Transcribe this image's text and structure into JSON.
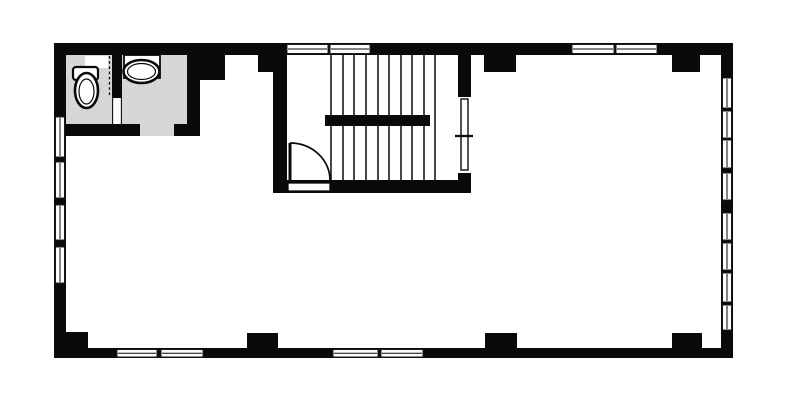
{
  "meta": {
    "drawing_type": "architectural-floor-plan",
    "visible_text": ""
  },
  "canvas": {
    "w": 787,
    "h": 401,
    "bg": "#ffffff"
  },
  "palette": {
    "wall": "#0a0a0a",
    "floor": "#ffffff",
    "bathroom_floor": "#d9d9d9",
    "bathroom_floor_dot": "#bdbdbd",
    "window_fill": "#fcfcfc",
    "window_frame": "#1a1a1a",
    "fixture_fill": "#ffffff",
    "line": "#0a0a0a"
  },
  "walls": {
    "outer": [
      {
        "name": "outer-wall-top",
        "x": 54,
        "y": 43,
        "w": 679,
        "h": 12
      },
      {
        "name": "outer-wall-bottom",
        "x": 54,
        "y": 348,
        "w": 679,
        "h": 10
      },
      {
        "name": "outer-wall-left",
        "x": 54,
        "y": 43,
        "w": 12,
        "h": 315
      },
      {
        "name": "outer-wall-right",
        "x": 721,
        "y": 43,
        "w": 12,
        "h": 315
      }
    ],
    "inner": [
      {
        "name": "bathroom-wall-right",
        "x": 187,
        "y": 55,
        "w": 13,
        "h": 81
      },
      {
        "name": "bathroom-wall-bottom-left",
        "x": 66,
        "y": 124,
        "w": 74,
        "h": 12
      },
      {
        "name": "bathroom-wall-bottom-right",
        "x": 174,
        "y": 124,
        "w": 26,
        "h": 12
      },
      {
        "name": "bathroom-partition",
        "x": 112,
        "y": 55,
        "w": 10,
        "h": 43
      },
      {
        "name": "stairwell-wall-left",
        "x": 273,
        "y": 55,
        "w": 14,
        "h": 138
      },
      {
        "name": "stairwell-wall-right-upper",
        "x": 458,
        "y": 55,
        "w": 13,
        "h": 42
      },
      {
        "name": "stairwell-wall-right-lower",
        "x": 458,
        "y": 173,
        "w": 13,
        "h": 20
      },
      {
        "name": "stairwell-wall-bottom",
        "x": 273,
        "y": 180,
        "w": 198,
        "h": 13
      }
    ]
  },
  "columns": [
    {
      "name": "column-top-bathroom",
      "x": 200,
      "y": 55,
      "w": 25,
      "h": 25
    },
    {
      "name": "column-top-stairwell",
      "x": 258,
      "y": 55,
      "w": 29,
      "h": 17
    },
    {
      "name": "column-top-mid-right",
      "x": 484,
      "y": 55,
      "w": 32,
      "h": 17
    },
    {
      "name": "column-top-right",
      "x": 672,
      "y": 55,
      "w": 28,
      "h": 17
    },
    {
      "name": "column-bottom-left",
      "x": 66,
      "y": 332,
      "w": 22,
      "h": 16
    },
    {
      "name": "column-bottom-mid-left",
      "x": 247,
      "y": 333,
      "w": 31,
      "h": 15
    },
    {
      "name": "column-bottom-mid-right",
      "x": 485,
      "y": 333,
      "w": 32,
      "h": 15
    },
    {
      "name": "column-bottom-right",
      "x": 672,
      "y": 333,
      "w": 30,
      "h": 15
    }
  ],
  "bathroom": {
    "floors": [
      {
        "name": "bathroom-floor-toilet-compartment",
        "x": 66,
        "y": 55,
        "w": 46,
        "h": 69
      },
      {
        "name": "bathroom-floor-basin-compartment",
        "x": 122,
        "y": 55,
        "w": 65,
        "h": 69
      },
      {
        "name": "bathroom-doorway-floor",
        "x": 140,
        "y": 124,
        "w": 34,
        "h": 12
      }
    ],
    "partition_gap": {
      "name": "bathroom-partition-doorway",
      "x": 112,
      "y": 98,
      "w": 10,
      "h": 26
    },
    "partition_gap_edges": [
      {
        "name": "partition-doorway-jamb-left",
        "x1": 112.6,
        "y1": 98,
        "x2": 112.6,
        "y2": 124
      },
      {
        "name": "partition-doorway-jamb-right",
        "x1": 121.4,
        "y1": 98,
        "x2": 121.4,
        "y2": 124
      }
    ],
    "dashed_screen": {
      "name": "toilet-screen-dashed-line",
      "x1": 109.5,
      "y1": 56,
      "x2": 109.5,
      "y2": 97,
      "dash": "2.6 2.6",
      "sw": 1.3
    },
    "niche": {
      "name": "wall-niche",
      "x": 85,
      "y": 56,
      "w": 23,
      "h": 12
    },
    "toilet": {
      "tank": {
        "name": "toilet-tank",
        "x": 73,
        "y": 67,
        "w": 25,
        "h": 13,
        "rx": 3,
        "sw": 2.2
      },
      "bowl_outer": {
        "name": "toilet-bowl",
        "cx": 86.5,
        "cy": 90.5,
        "rx": 11.5,
        "ry": 17.5,
        "sw": 2.6
      },
      "bowl_inner": {
        "name": "toilet-bowl-inner-rim",
        "cx": 86.5,
        "cy": 91.5,
        "rx": 7.5,
        "ry": 12.5,
        "sw": 1.2
      }
    },
    "sink": {
      "counter": {
        "name": "sink-counter",
        "x": 124,
        "y": 55,
        "w": 36,
        "h": 23,
        "sw": 1.8
      },
      "basin_outer": {
        "name": "sink-basin",
        "cx": 141.5,
        "cy": 71.5,
        "rx": 18,
        "ry": 11.5,
        "sw": 2.6
      },
      "basin_inner": {
        "name": "sink-basin-inner-rim",
        "cx": 141.5,
        "cy": 71.5,
        "rx": 14,
        "ry": 8,
        "sw": 1.2
      }
    }
  },
  "stairwell": {
    "treads": {
      "name": "stair-treads",
      "xs": [
        331,
        343,
        354,
        366,
        378,
        389,
        401,
        412,
        424,
        435
      ],
      "y1": 54,
      "y2": 180,
      "sw": 1.5
    },
    "landing_bar": {
      "name": "stair-landing-bar",
      "x": 325,
      "y": 115,
      "w": 105,
      "h": 11
    },
    "entry_door": {
      "threshold": {
        "name": "stair-entry-door-threshold",
        "x": 288,
        "y": 183,
        "w": 42,
        "h": 8,
        "sw": 1.3
      },
      "leaf": {
        "name": "stair-entry-door-leaf",
        "x1": 290,
        "y1": 143,
        "x2": 290,
        "y2": 180,
        "sw": 3
      },
      "swing": {
        "name": "stair-entry-door-swing-arc",
        "d": "M 290 143 A 40 37 0 0 1 330 180",
        "sw": 1.7
      }
    },
    "side_door": {
      "leaf": {
        "name": "stairwell-side-door-leaf",
        "x": 461,
        "y": 99,
        "w": 7,
        "h": 71,
        "sw": 1.4
      },
      "tick": {
        "name": "stairwell-side-door-latch",
        "x1": 455,
        "y1": 136,
        "x2": 473,
        "y2": 136,
        "sw": 2.2
      }
    }
  },
  "windows": [
    {
      "name": "window-left-1",
      "x": 55.5,
      "y": 117,
      "w": 9,
      "h": 40,
      "dir": "v"
    },
    {
      "name": "window-left-2",
      "x": 55.5,
      "y": 162,
      "w": 9,
      "h": 36,
      "dir": "v"
    },
    {
      "name": "window-left-3",
      "x": 55.5,
      "y": 205,
      "w": 9,
      "h": 35,
      "dir": "v"
    },
    {
      "name": "window-left-4",
      "x": 55.5,
      "y": 247,
      "w": 9,
      "h": 36,
      "dir": "v"
    },
    {
      "name": "window-right-1",
      "x": 722.5,
      "y": 78,
      "w": 9,
      "h": 30,
      "dir": "v"
    },
    {
      "name": "window-right-2",
      "x": 722.5,
      "y": 111,
      "w": 9,
      "h": 27,
      "dir": "v"
    },
    {
      "name": "window-right-3",
      "x": 722.5,
      "y": 140,
      "w": 9,
      "h": 28,
      "dir": "v"
    },
    {
      "name": "window-right-4",
      "x": 722.5,
      "y": 173,
      "w": 9,
      "h": 27,
      "dir": "v"
    },
    {
      "name": "window-right-5",
      "x": 722.5,
      "y": 213,
      "w": 9,
      "h": 27,
      "dir": "v"
    },
    {
      "name": "window-right-6",
      "x": 722.5,
      "y": 243,
      "w": 9,
      "h": 27,
      "dir": "v"
    },
    {
      "name": "window-right-7",
      "x": 722.5,
      "y": 273,
      "w": 9,
      "h": 29,
      "dir": "v"
    },
    {
      "name": "window-right-8",
      "x": 722.5,
      "y": 305,
      "w": 9,
      "h": 25,
      "dir": "v"
    },
    {
      "name": "window-top-1",
      "x": 287,
      "y": 44.5,
      "w": 41,
      "h": 9,
      "dir": "h"
    },
    {
      "name": "window-top-2",
      "x": 330,
      "y": 44.5,
      "w": 40,
      "h": 9,
      "dir": "h"
    },
    {
      "name": "window-top-3",
      "x": 572,
      "y": 44.5,
      "w": 42,
      "h": 9,
      "dir": "h"
    },
    {
      "name": "window-top-4",
      "x": 616,
      "y": 44.5,
      "w": 41,
      "h": 9,
      "dir": "h"
    },
    {
      "name": "window-bottom-1",
      "x": 117,
      "y": 349.5,
      "w": 40,
      "h": 7.5,
      "dir": "h"
    },
    {
      "name": "window-bottom-2",
      "x": 161,
      "y": 349.5,
      "w": 42,
      "h": 7.5,
      "dir": "h"
    },
    {
      "name": "window-bottom-3",
      "x": 333,
      "y": 349.5,
      "w": 45,
      "h": 7.5,
      "dir": "h"
    },
    {
      "name": "window-bottom-4",
      "x": 381,
      "y": 349.5,
      "w": 42,
      "h": 7.5,
      "dir": "h"
    }
  ]
}
